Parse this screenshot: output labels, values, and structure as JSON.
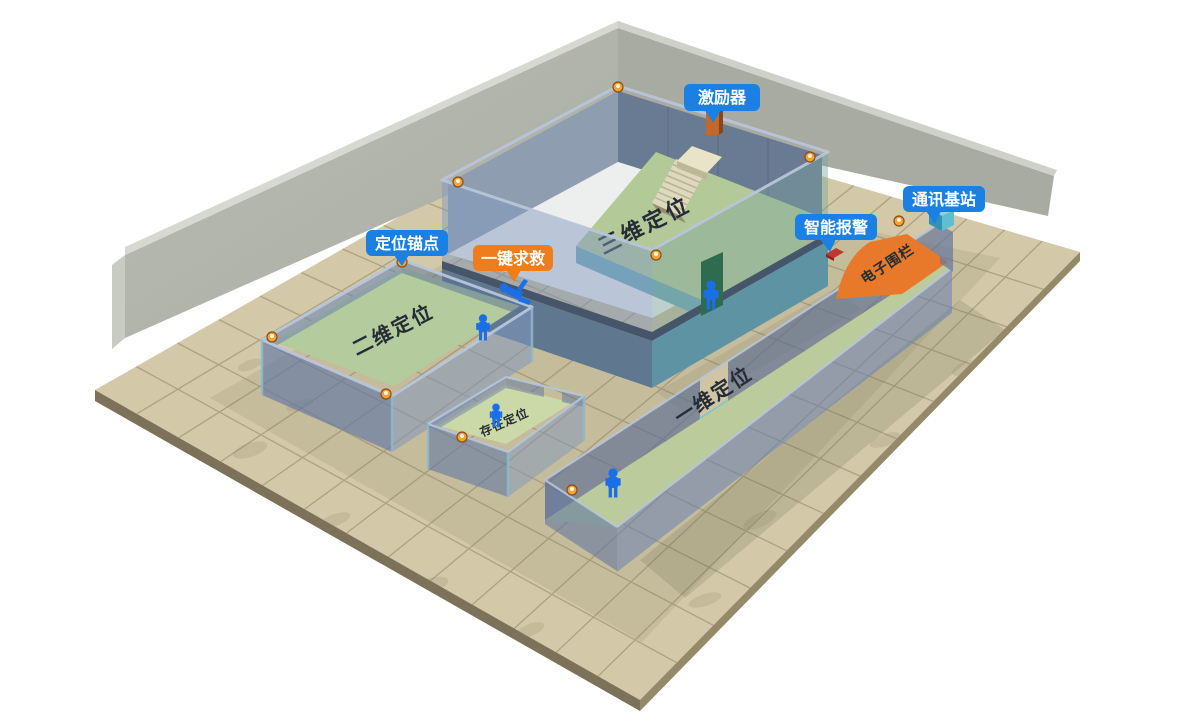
{
  "scene": {
    "labels": {
      "exciter": "激励器",
      "comm_base": "通讯基站",
      "smart_alarm": "智能报警",
      "anchor_point": "定位锚点",
      "sos": "一键求救",
      "fence": "电子围栏"
    },
    "zones": {
      "zone_3d": "三维定位",
      "zone_2d": "二维定位",
      "zone_presence": "存在定位",
      "zone_1d": "一维定位"
    },
    "colors": {
      "label_blue": "#1b80e4",
      "label_orange": "#ee7d1d",
      "fence_orange": "#e8792a",
      "floor_tan": "#d3c8a8",
      "room_floor_green": "#b4cb9d",
      "wall_gray": "#b4b7ae",
      "person_blue": "#1a6fe8",
      "anchor_orange": "#f2a23a",
      "stairs_cream": "#e9e3c8",
      "exciter_device_orange": "#c2692a",
      "alarm_device_red": "#bf3a2e",
      "door_green": "#2f6b4f",
      "comm_device_teal": "#2f93b4"
    }
  }
}
